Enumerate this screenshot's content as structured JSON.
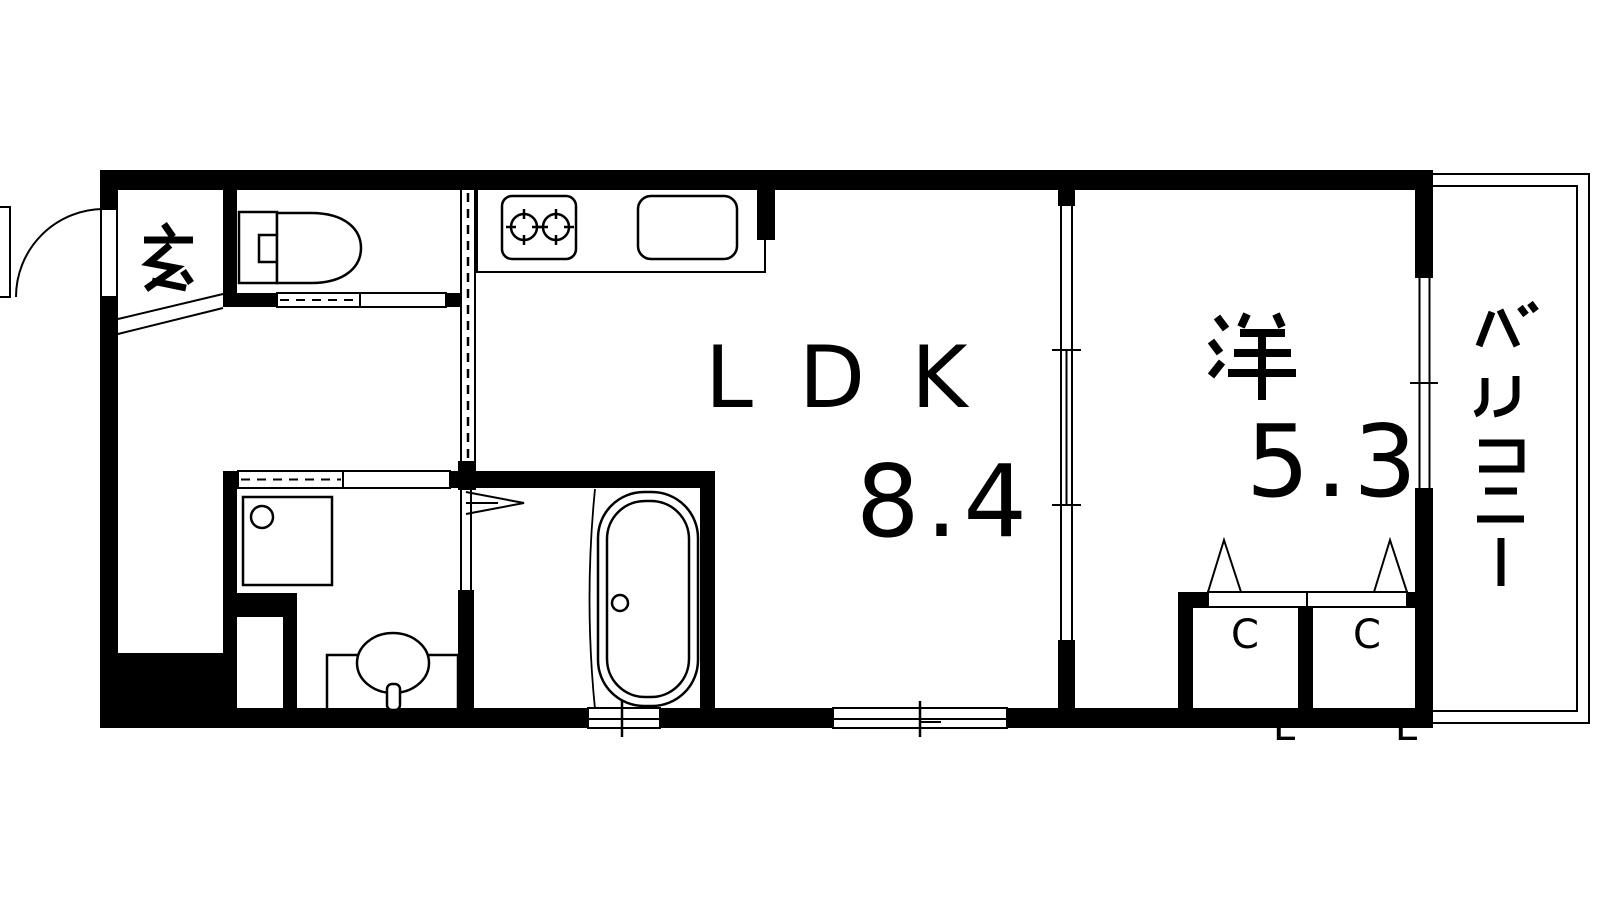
{
  "rooms": {
    "entrance": {
      "label": "玄"
    },
    "ldk": {
      "label": "LDK",
      "size": "8.4"
    },
    "western": {
      "label": "洋",
      "size": "5.3"
    },
    "balcony": {
      "label": "バルコニー"
    },
    "closet_left": {
      "letters": [
        "C",
        "L"
      ]
    },
    "closet_right": {
      "letters": [
        "C",
        "L"
      ]
    }
  },
  "colors": {
    "wall": "#000000",
    "floor": "#ffffff"
  }
}
